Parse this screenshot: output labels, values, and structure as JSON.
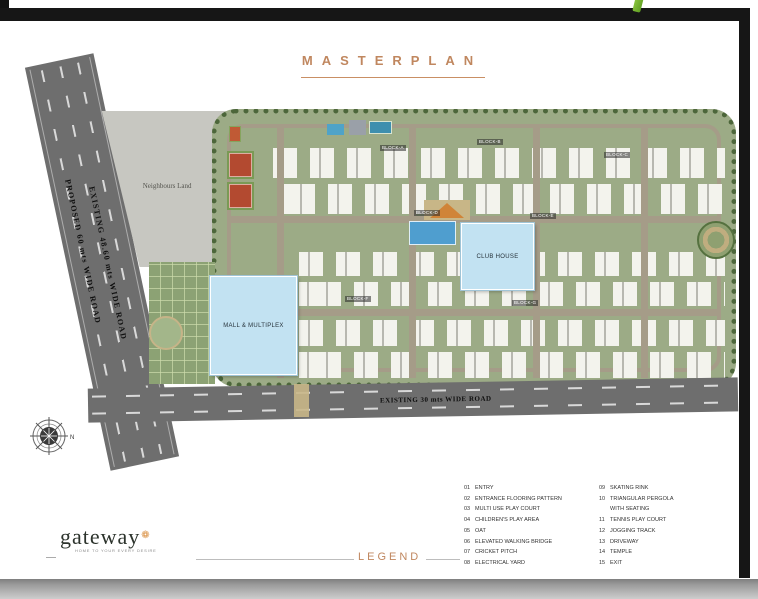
{
  "page": {
    "title": "MASTERPLAN"
  },
  "plan": {
    "roads": {
      "left_primary": "PROPOSED  60 mts   WIDE ROAD",
      "left_secondary": "EXISTING 48.60 mts WIDE ROAD",
      "bottom": "EXISTING 30 mts WIDE ROAD"
    },
    "neighbours_land": "Neighbours Land",
    "mall": "MALL & MULTIPLEX",
    "clubhouse": "CLUB HOUSE",
    "blocks": [
      "BLOCK-A",
      "BLOCK-B",
      "BLOCK-C",
      "BLOCK-D",
      "BLOCK-E",
      "BLOCK-F",
      "BLOCK-G"
    ],
    "compass_n": "N"
  },
  "footer": {
    "logo_text": "gateway",
    "logo_mark": "❁",
    "logo_tagline": "HOME TO YOUR EVERY DESIRE",
    "legend_title": "LEGEND",
    "legend_col1": [
      {
        "num": "01",
        "label": "ENTRY"
      },
      {
        "num": "02",
        "label": "ENTRANCE FLOORING PATTERN"
      },
      {
        "num": "03",
        "label": "MULTI USE PLAY COURT"
      },
      {
        "num": "04",
        "label": "CHILDREN'S PLAY AREA"
      },
      {
        "num": "05",
        "label": "OAT"
      },
      {
        "num": "06",
        "label": "ELEVATED WALKING BRIDGE"
      },
      {
        "num": "07",
        "label": "CRICKET PITCH"
      },
      {
        "num": "08",
        "label": "ELECTRICAL YARD"
      }
    ],
    "legend_col2": [
      {
        "num": "09",
        "label": "SKATING RINK"
      },
      {
        "num": "10",
        "label": "TRIANGULAR PERGOLA"
      },
      {
        "num": "",
        "label": "WITH SEATING"
      },
      {
        "num": "11",
        "label": "TENNIS PLAY COURT"
      },
      {
        "num": "12",
        "label": "JOGGING TRACK"
      },
      {
        "num": "13",
        "label": "DRIVEWAY"
      },
      {
        "num": "14",
        "label": "TEMPLE"
      },
      {
        "num": "15",
        "label": "EXIT"
      }
    ]
  },
  "colors": {
    "accent_copper": "#c0875f",
    "parcel_green": "#9cab86",
    "road_gray": "#6e6e6e",
    "water_blue": "#c2e2f2",
    "frame_black": "#161616",
    "stem_green": "#76b82a"
  }
}
